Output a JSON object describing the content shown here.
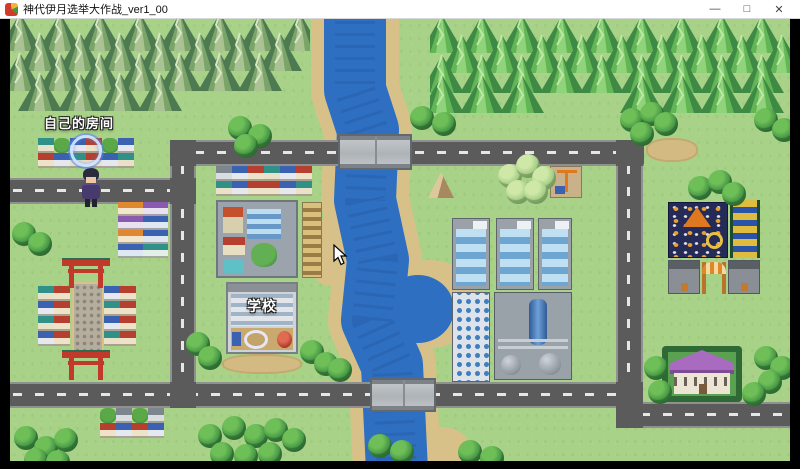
{
  "window": {
    "title": "神代伊月选举大作战_ver1_00",
    "app_icon": "rpg-game-icon",
    "controls": {
      "minimize": "—",
      "maximize": "□",
      "close": "✕"
    }
  },
  "game": {
    "labels": {
      "room": "自己的房间",
      "school": "学校"
    },
    "cursor": "arrow-cursor",
    "highlight": "blue-circle-marker",
    "colors": {
      "grass": "#a8d287",
      "road": "#5b5b5b",
      "road_dash": "#e6e6e6",
      "water": "#2f6fc1",
      "sand": "#d8c189",
      "bridge": "#b9bcc0",
      "mountain": "#3e8a44",
      "tree": "#3e8f42",
      "torii_red": "#c0392b",
      "mansion_roof": "#a86bc0",
      "park_base": "#232b56",
      "titlebar_bg": "#ffffff"
    }
  }
}
